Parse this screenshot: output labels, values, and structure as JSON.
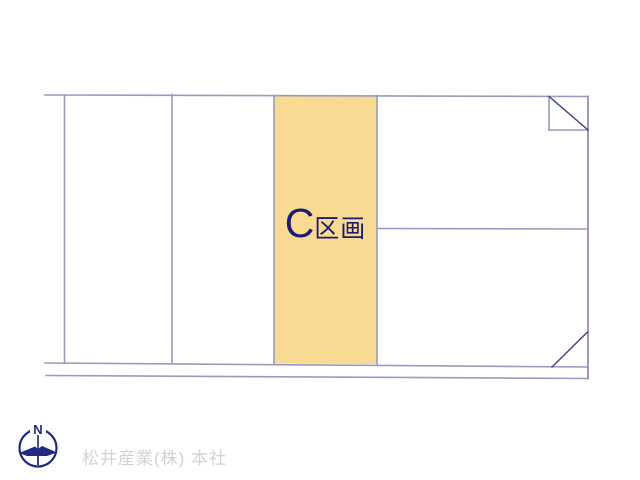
{
  "canvas": {
    "width": 640,
    "height": 480,
    "background": "#ffffff"
  },
  "colors": {
    "line": "#9a9ac0",
    "diagonal": "#3f3f8a",
    "parcel_fill": "#f9da92",
    "parcel_label": "#1c1c72",
    "compass": "#1e2b80",
    "company_text": "#d2d2d2"
  },
  "parcel": {
    "letter": "C",
    "suffix": "区画"
  },
  "compass": {
    "north_label": "N"
  },
  "footer": {
    "company": "松井産業(株) 本社"
  }
}
